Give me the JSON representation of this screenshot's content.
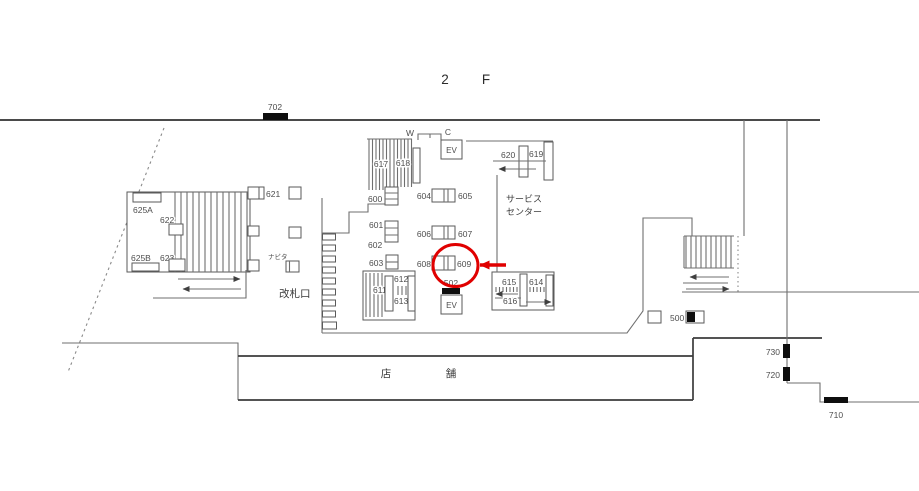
{
  "title": {
    "floor_number": "2",
    "floor_letter": "F"
  },
  "colors": {
    "background": "#ffffff",
    "wall": "#6f6f6f",
    "label": "#4d4d4d",
    "black_bar": "#0e0e0e",
    "highlight": "#e00000"
  },
  "highlight": {
    "circled_label": "609"
  },
  "labels": {
    "n702": "702",
    "n625A": "625A",
    "n622": "622",
    "n623": "623",
    "n625B": "625B",
    "n621": "621",
    "n617": "617",
    "n618": "618",
    "w": "W",
    "c": "C",
    "ev_upper": "EV",
    "ev_lower": "EV",
    "n600": "600",
    "n601": "601",
    "n602": "602",
    "n603": "603",
    "n604": "604",
    "n605": "605",
    "n606": "606",
    "n607": "607",
    "n608": "608",
    "n609": "609",
    "n502": "502",
    "n611": "611",
    "n612": "612",
    "n613": "613",
    "n614": "614",
    "n615": "615",
    "n616": "616",
    "n619": "619",
    "n620": "620",
    "n500": "500",
    "n730": "730",
    "n720": "720",
    "n710": "710",
    "service_center_line1": "サービス",
    "service_center_line2": "センター",
    "ticket_gate": "改札口",
    "navita": "ナビタ",
    "shop_char1": "店",
    "shop_char2": "舗"
  }
}
